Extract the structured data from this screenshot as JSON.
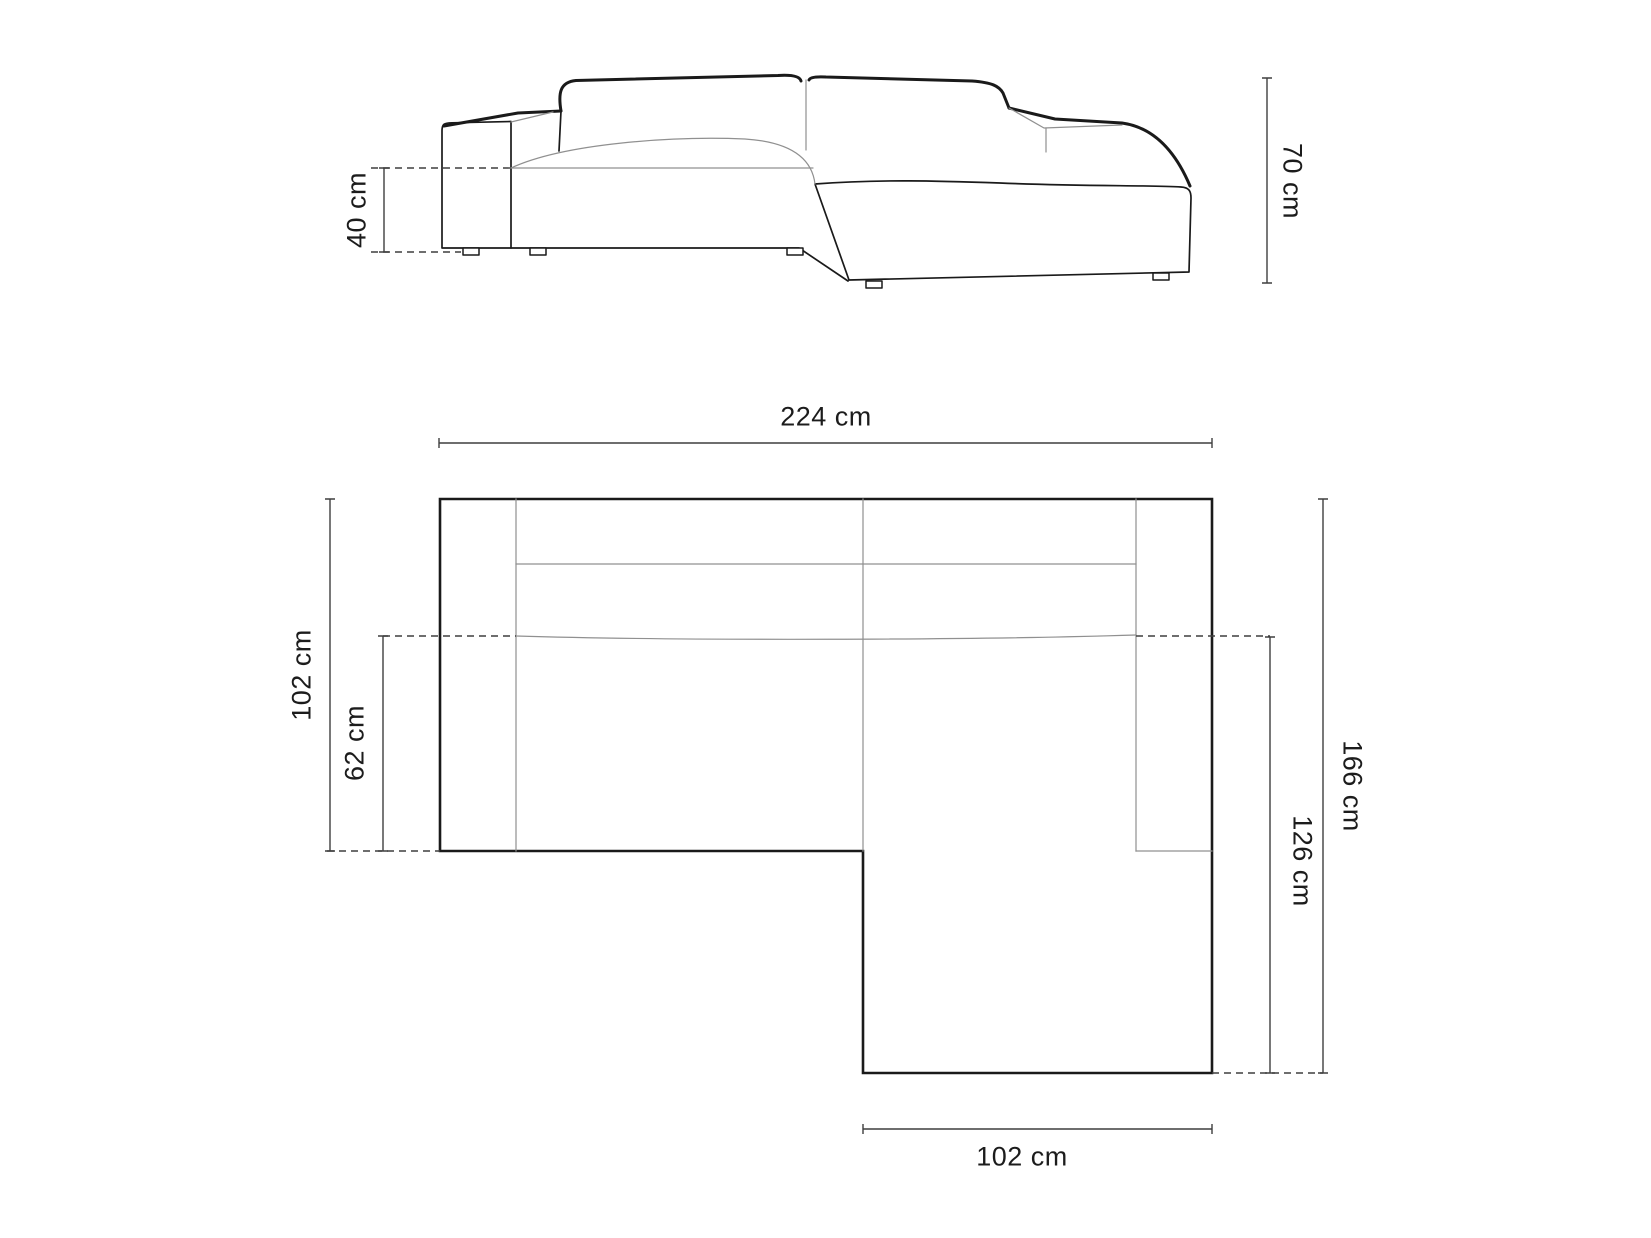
{
  "diagram": {
    "type": "furniture-dimension-drawing",
    "subject": "corner-sofa-with-chaise",
    "views": {
      "front_elevation": "front elevation view",
      "top_plan": "top plan view"
    },
    "labels": {
      "seat_height": "40 cm",
      "overall_height": "70 cm",
      "overall_width": "224 cm",
      "left_depth": "102 cm",
      "left_seat_depth": "62 cm",
      "right_overall_depth": "166 cm",
      "chaise_depth": "126 cm",
      "chaise_width": "102 cm"
    },
    "colors": {
      "line": "#1a1a1a",
      "seam": "#909090",
      "dim": "#3f3f3f",
      "text": "#1c1c1c",
      "background": "#ffffff"
    }
  }
}
